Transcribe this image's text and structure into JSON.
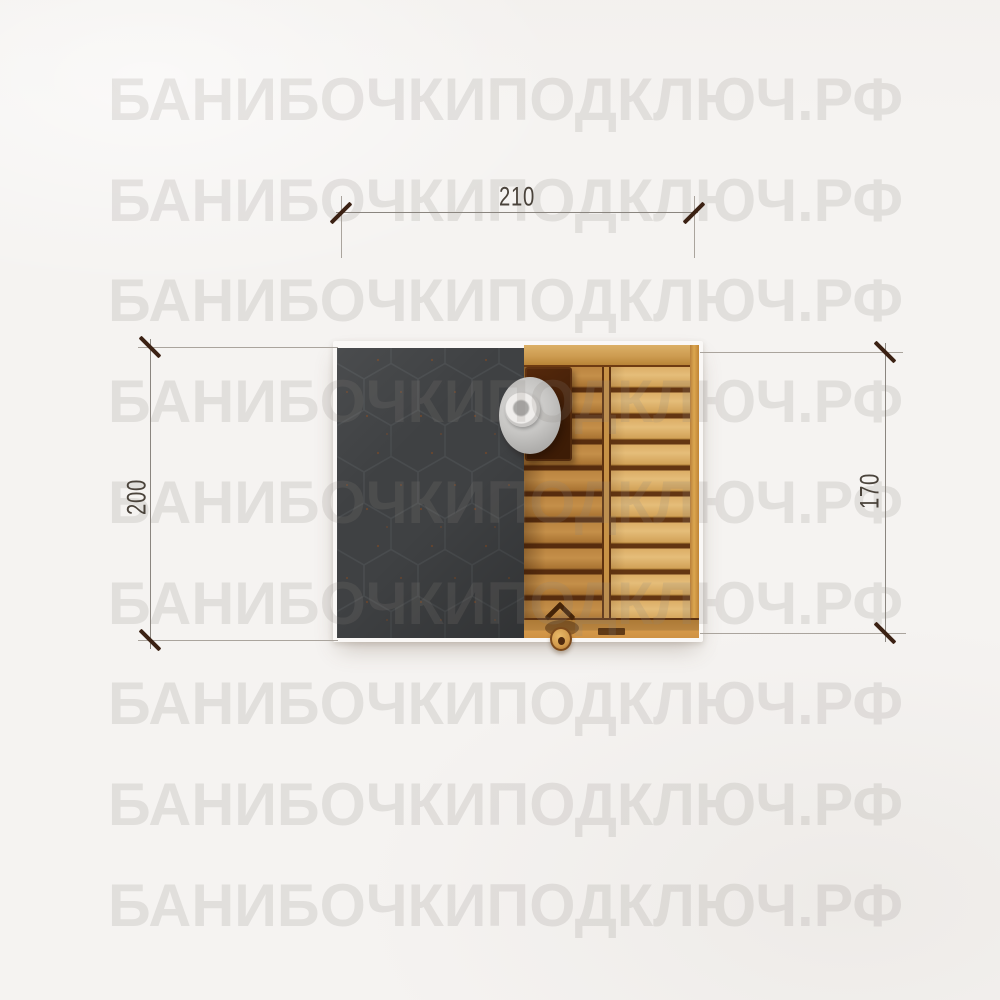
{
  "page": {
    "background_color": "#f5f3f1",
    "description": "Top-view plan drawing of a barrel sauna with exterior dimensions"
  },
  "watermark": {
    "text": "БАНИБОЧКИПОДКЛЮЧ.РФ",
    "row_count": 9,
    "color": "rgba(139,133,127,0.18)"
  },
  "dimensions": {
    "top_width": {
      "label": "210"
    },
    "left_depth": {
      "label": "200"
    },
    "right_depth": {
      "label": "170"
    }
  },
  "drawing": {
    "roof_color": "#3f4143",
    "roof_pattern": "hexagon-shingles",
    "wood_mid_color": "#bb8540",
    "wood_right_color": "#dcae67",
    "plank_gap_color": "#5e3010",
    "rail_color": "#cd9c51",
    "chimney_cap_color": "#c6c5c3",
    "dimension_line_color": "#8a857f",
    "dimension_tick_color": "#3b2113",
    "dimension_text_color": "#4a433b"
  }
}
